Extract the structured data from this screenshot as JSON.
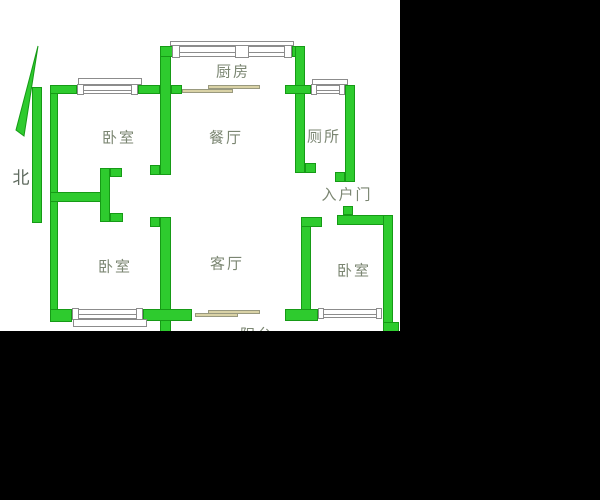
{
  "compass": {
    "label": "北"
  },
  "rooms": [
    {
      "id": "bedroom-top-left",
      "label": "卧室"
    },
    {
      "id": "dining-room",
      "label": "餐厅"
    },
    {
      "id": "kitchen",
      "label": "厨房"
    },
    {
      "id": "toilet",
      "label": "厕所"
    },
    {
      "id": "entrance-door",
      "label": "入户门"
    },
    {
      "id": "bedroom-bottom-left",
      "label": "卧室"
    },
    {
      "id": "living-room",
      "label": "客厅"
    },
    {
      "id": "bedroom-bottom-right",
      "label": "卧室"
    },
    {
      "id": "balcony",
      "label": "阳台"
    }
  ],
  "colors": {
    "background": "#000000",
    "floor": "#ffffff",
    "wall_fill": "#2ecb2e",
    "wall_border": "#169a16",
    "window_frame": "#8c8c8c",
    "door": "#d9d2a6",
    "label_text": "#7b8672",
    "compass_text": "#5f6b5f"
  }
}
